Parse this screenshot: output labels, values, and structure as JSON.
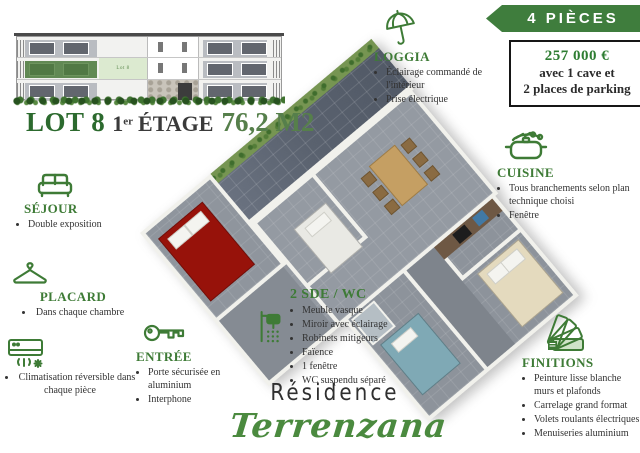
{
  "header": {
    "lot_label": "LOT 8",
    "floor_number": "1",
    "floor_sup": "er",
    "floor_word": "ÉTAGE",
    "area": "76,2 M2",
    "elevation_lot_tag": "Lot 8"
  },
  "banner": {
    "label": "4 PIÈCES"
  },
  "price_box": {
    "price": "257 000 €",
    "line2": "avec 1 cave et",
    "line3": "2 places de parking"
  },
  "callouts": {
    "sejour": {
      "title": "SÉJOUR",
      "icon": "sofa-icon",
      "bullets": [
        "Double exposition"
      ]
    },
    "placard": {
      "title": "PLACARD",
      "icon": "hanger-icon",
      "bullets": [
        "Dans chaque chambre"
      ]
    },
    "climatisation": {
      "icon": "air-conditioner-icon",
      "bullets": [
        "Climatisation réversible dans chaque pièce"
      ]
    },
    "entree": {
      "title": "ENTRÉE",
      "icon": "key-icon",
      "bullets": [
        "Porte sécurisée en aluminium",
        "Interphone"
      ]
    },
    "loggia": {
      "title": "LOGGIA",
      "icon": "umbrella-icon",
      "bullets": [
        "Éclairage commandé de l'intérieur",
        "Prise électrique"
      ]
    },
    "cuisine": {
      "title": "CUISINE",
      "icon": "cooking-pot-icon",
      "bullets": [
        "Tous branchements selon plan technique choisi",
        "Fenêtre"
      ]
    },
    "sde": {
      "title": "2 SDE / WC",
      "icon": "shower-icon",
      "bullets": [
        "Meuble vasque",
        "Miroir avec éclairage",
        "Robinets mitigeurs",
        "Faïence",
        "1 fenêtre",
        "WC suspendu séparé"
      ]
    },
    "finitions": {
      "title": "FINITIONS",
      "icon": "swatch-fan-icon",
      "bullets": [
        "Peinture lisse blanche murs et plafonds",
        "Carrelage grand format",
        "Volets roulants électriques",
        "Menuiseries aluminium"
      ]
    }
  },
  "logo": {
    "line1": "Résidence",
    "line2": "Terrenzana"
  },
  "colors": {
    "accent_green": "#3e7b36",
    "banner_green": "#3f7d3d",
    "price_green": "#2e7d32",
    "lot_green": "#2c6a2e",
    "area_green": "#567f4b",
    "logo_green": "#4b8a3f",
    "loggia_tile": "#565e6b",
    "floor_tile": "#949aa2",
    "red_bed": "#97120a",
    "teal_bed": "#7fa9b5",
    "cream_bed": "#e4dabe"
  }
}
